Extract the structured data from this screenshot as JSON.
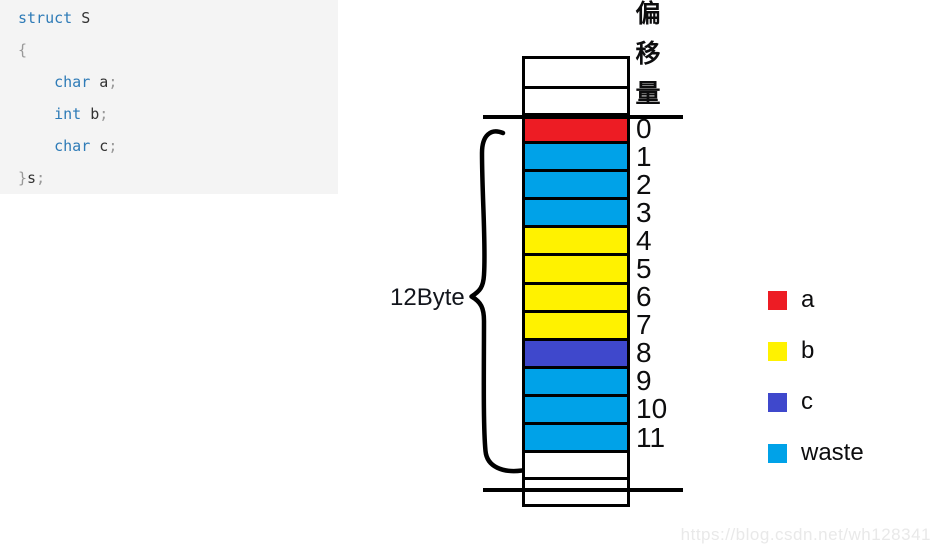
{
  "code": {
    "token_colors": {
      "kw": "#2e7bb7",
      "id": "#333333",
      "pn": "#999999"
    },
    "lines": [
      [
        {
          "t": "struct",
          "c": "kw"
        },
        {
          "t": " S",
          "c": "id"
        }
      ],
      [
        {
          "t": "{",
          "c": "pn"
        }
      ],
      [
        {
          "t": "    ",
          "c": "id"
        },
        {
          "t": "char",
          "c": "kw"
        },
        {
          "t": " a",
          "c": "id"
        },
        {
          "t": ";",
          "c": "pn"
        }
      ],
      [
        {
          "t": "    ",
          "c": "id"
        },
        {
          "t": "int",
          "c": "kw"
        },
        {
          "t": " b",
          "c": "id"
        },
        {
          "t": ";",
          "c": "pn"
        }
      ],
      [
        {
          "t": "    ",
          "c": "id"
        },
        {
          "t": "char",
          "c": "kw"
        },
        {
          "t": " c",
          "c": "id"
        },
        {
          "t": ";",
          "c": "pn"
        }
      ],
      [
        {
          "t": "}",
          "c": "pn"
        },
        {
          "t": "s",
          "c": "id"
        },
        {
          "t": ";",
          "c": "pn"
        }
      ]
    ]
  },
  "colors": {
    "a": "#ed1c24",
    "b": "#fff200",
    "c": "#3f48cc",
    "waste": "#00a2e8",
    "white": "#ffffff"
  },
  "memory": {
    "offset_header": "偏移量",
    "size_label": "12Byte",
    "cells": [
      {
        "label": "",
        "fill": "white"
      },
      {
        "label": "",
        "fill": "white"
      },
      {
        "label": "0",
        "fill": "a"
      },
      {
        "label": "1",
        "fill": "waste"
      },
      {
        "label": "2",
        "fill": "waste"
      },
      {
        "label": "3",
        "fill": "waste"
      },
      {
        "label": "4",
        "fill": "b"
      },
      {
        "label": "5",
        "fill": "b"
      },
      {
        "label": "6",
        "fill": "b"
      },
      {
        "label": "7",
        "fill": "b"
      },
      {
        "label": "8",
        "fill": "c"
      },
      {
        "label": "9",
        "fill": "waste"
      },
      {
        "label": "10",
        "fill": "waste"
      },
      {
        "label": "11",
        "fill": "waste"
      },
      {
        "label": "",
        "fill": "white"
      },
      {
        "label": "",
        "fill": "white"
      }
    ]
  },
  "legend": {
    "items": [
      {
        "label": "a",
        "fill": "a"
      },
      {
        "label": "b",
        "fill": "b"
      },
      {
        "label": "c",
        "fill": "c"
      },
      {
        "label": "waste",
        "fill": "waste"
      }
    ]
  },
  "watermark": {
    "text": "https://blog.csdn.net/wh128341"
  }
}
